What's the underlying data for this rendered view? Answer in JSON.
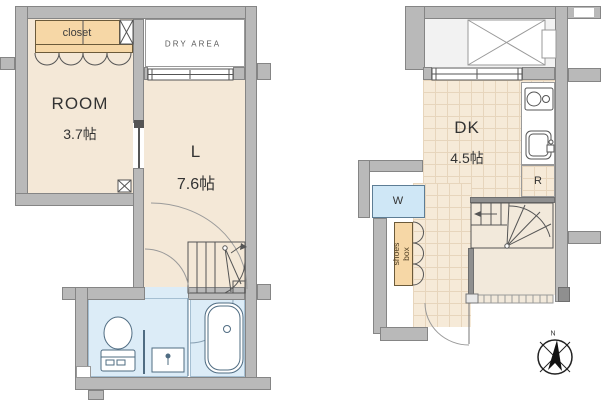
{
  "palette": {
    "wall_gray": "#b9b9b9",
    "room_floor": "#f4e8d7",
    "tile_floor": "#f6ead8",
    "wet_area_blue": "#dcecf7",
    "storage_orange": "#f6d7a6",
    "line_color": "#555555"
  },
  "left_unit": {
    "closet": "closet",
    "dry_area": "DRY AREA",
    "room": "ROOM",
    "room_size": "3.7帖",
    "living": "L",
    "living_size": "7.6帖"
  },
  "right_unit": {
    "dining_kitchen": "DK",
    "dk_size": "4.5帖",
    "washer": "W",
    "shoes_box": "shoes box",
    "refrigerator": "R",
    "compass_north": "N"
  }
}
